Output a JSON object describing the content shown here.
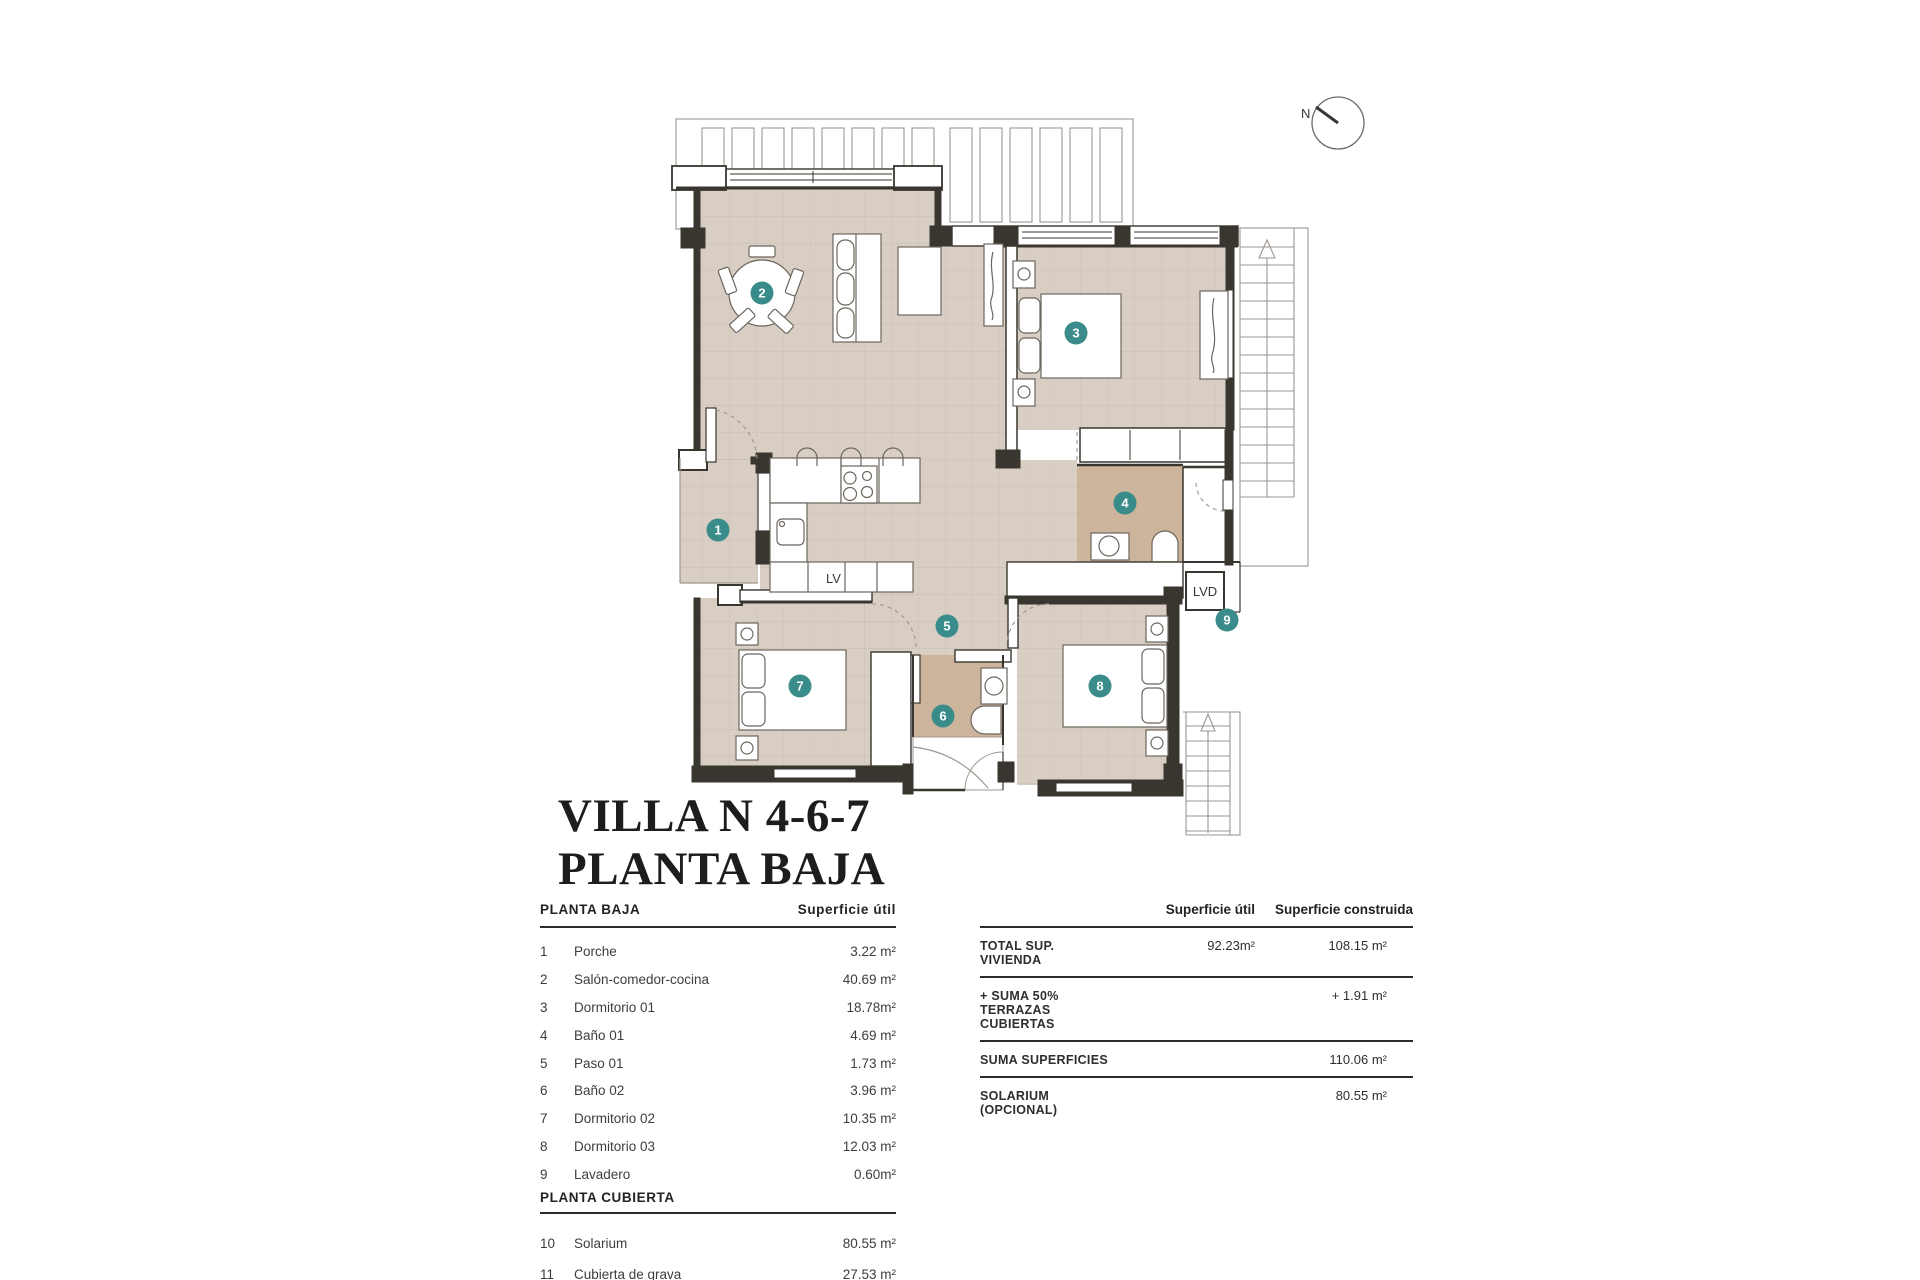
{
  "title": {
    "line1": "VILLA N 4-6-7",
    "line2": "PLANTA BAJA"
  },
  "compass": {
    "north_label": "N"
  },
  "plan": {
    "kitchen_dishwasher_label": "LV",
    "laundry_label": "LVD",
    "rooms": [
      {
        "num": "1"
      },
      {
        "num": "2"
      },
      {
        "num": "3"
      },
      {
        "num": "4"
      },
      {
        "num": "5"
      },
      {
        "num": "6"
      },
      {
        "num": "7"
      },
      {
        "num": "8"
      },
      {
        "num": "9"
      }
    ]
  },
  "left_table": {
    "sections": [
      {
        "header": "PLANTA BAJA",
        "value_header": "Superficie útil",
        "rows": [
          {
            "num": "1",
            "name": "Porche",
            "value": "3.22 m²"
          },
          {
            "num": "2",
            "name": "Salón-comedor-cocina",
            "value": "40.69 m²"
          },
          {
            "num": "3",
            "name": "Dormitorio 01",
            "value": "18.78m²"
          },
          {
            "num": "4",
            "name": "Baño 01",
            "value": "4.69 m²"
          },
          {
            "num": "5",
            "name": "Paso 01",
            "value": "1.73 m²"
          },
          {
            "num": "6",
            "name": "Baño 02",
            "value": "3.96 m²"
          },
          {
            "num": "7",
            "name": "Dormitorio 02",
            "value": "10.35 m²"
          },
          {
            "num": "8",
            "name": "Dormitorio 03",
            "value": "12.03 m²"
          },
          {
            "num": "9",
            "name": "Lavadero",
            "value": "0.60m²"
          }
        ]
      },
      {
        "header": "PLANTA CUBIERTA",
        "rows": [
          {
            "num": "10",
            "name": "Solarium",
            "value": "80.55 m²"
          },
          {
            "num": "11",
            "name": "Cubierta de grava",
            "value": "27.53 m²"
          }
        ]
      }
    ]
  },
  "summary_table": {
    "col_util": "Superficie útil",
    "col_construida": "Superficie construida",
    "rows": [
      {
        "label": "TOTAL SUP. VIVIENDA",
        "util": "92.23m²",
        "construida": "108.15 m²"
      },
      {
        "label": "+ SUMA 50% TERRAZAS CUBIERTAS",
        "util": "",
        "construida": "+ 1.91 m²"
      },
      {
        "label": "SUMA SUPERFICIES",
        "util": "",
        "construida": "110.06 m²"
      },
      {
        "label": "SOLARIUM (OPCIONAL)",
        "util": "",
        "construida": "80.55 m²"
      }
    ]
  },
  "colors": {
    "accent_teal": "#3a8c8a",
    "floor": "#d8cec3",
    "bath_floor": "#cdb49c",
    "wall": "#39362f"
  }
}
